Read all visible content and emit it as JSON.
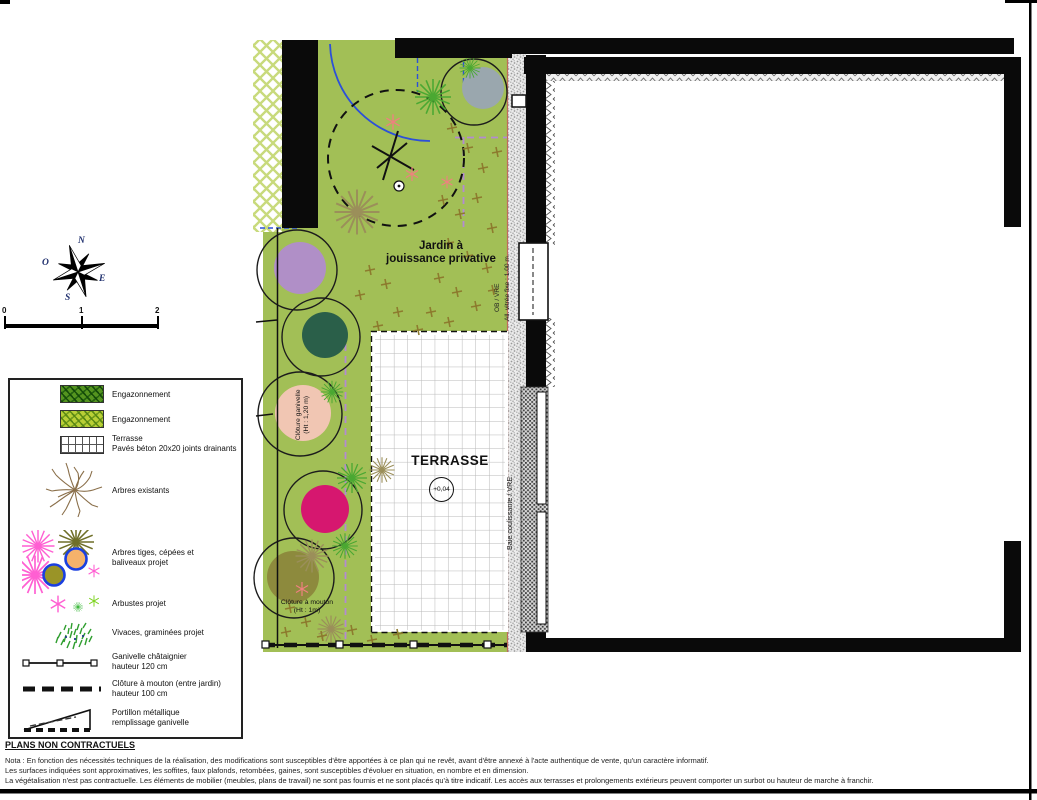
{
  "colors": {
    "garden_green": "#a2bf56",
    "hatch_line": "#c8da7c",
    "violet_fence": "#b48ad2",
    "blue_line": "#2c50d8",
    "salmon": "#f08080",
    "cross_brown": "#8d7b2e",
    "tree_grey": "#9aa7ae",
    "tree_purple": "#b08fc7",
    "tree_teal": "#2a5f49",
    "tree_peach": "#f1c6b3",
    "tree_magenta": "#d6176f",
    "tree_olive": "#8d8a3d",
    "star_green": "#4aa832",
    "star_tan": "#9b8f5a",
    "legend_pink": "#ff5fd2",
    "legend_blue": "#1a3fe0"
  },
  "compass": {
    "n": "N",
    "o": "O",
    "e": "E",
    "s": "S"
  },
  "scalebar": {
    "ticks": [
      "0",
      "1",
      "2"
    ]
  },
  "legend": {
    "items": [
      {
        "label": "Engazonnement"
      },
      {
        "label": "Engazonnement"
      },
      {
        "label": "Terrasse\nPavés béton 20x20 joints drainants"
      },
      {
        "label": "Arbres existants"
      },
      {
        "label": "Arbres tiges, cépées et\nbaliveaux projet"
      },
      {
        "label": "Arbustes projet"
      },
      {
        "label": "Vivaces, graminées projet"
      },
      {
        "label": "Ganivelle châtaignier\nhauteur 120 cm"
      },
      {
        "label": "Clôture à mouton (entre jardin)\nhauteur 100 cm"
      },
      {
        "label": "Portillon métallique\nremplissage ganivelle"
      }
    ]
  },
  "plan": {
    "garden_label": "Jardin à\njouissance privative",
    "terrace_label": "TERRASSE",
    "terrace_level": "+0,04",
    "fence_ganivelle_note": "Clôture ganivelle\n(Ht : 1,20 m)",
    "fence_mouton_note": "Clôture à mouton\n(Ht : 1m)",
    "window_note_ob": "OB / VRE",
    "window_note_fixed": "All. vitrée fixe : 1.00 m",
    "window_note_bay": "Baie coulissante / VRE"
  },
  "footer": {
    "title": "PLANS NON CONTRACTUELS",
    "notes": [
      "Nota : En fonction des nécessités techniques de la réalisation, des modifications sont susceptibles d'être apportées à ce plan qui ne revêt, avant d'être annexé à l'acte authentique de vente, qu'un caractère informatif.",
      "Les surfaces indiquées sont approximatives, les soffites, faux plafonds, retombées, gaines, sont susceptibles d'évoluer en situation, en nombre et en dimension.",
      "La végétalisation n'est pas contractuelle. Les éléments de mobilier (meubles, plans de travail) ne sont pas fournis et ne sont placés qu'à titre indicatif. Les accès aux terrasses et prolongements extérieurs peuvent comporter un surbot ou hauteur de marche à franchir."
    ]
  }
}
